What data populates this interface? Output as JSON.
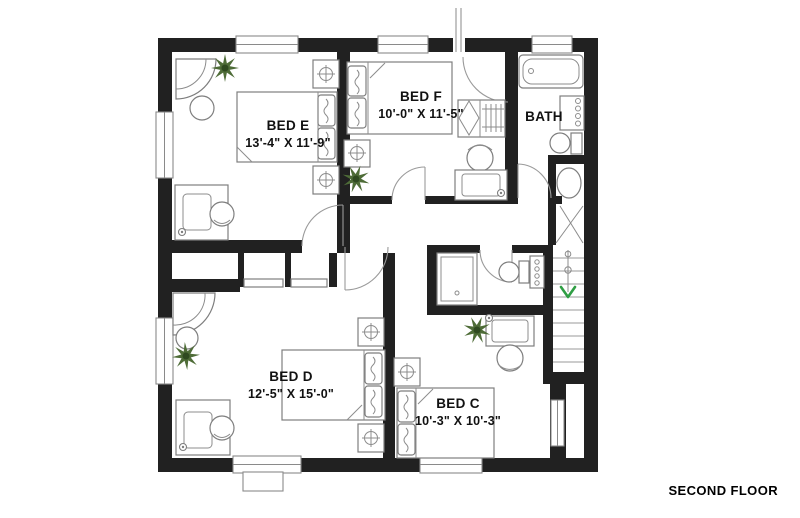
{
  "title": "SECOND FLOOR",
  "rooms": [
    {
      "id": "bed-e",
      "name": "BED E",
      "dims": "13'-4\" X 11'-9\""
    },
    {
      "id": "bed-f",
      "name": "BED F",
      "dims": "10'-0\" X 11'-5\""
    },
    {
      "id": "bath",
      "name": "BATH",
      "dims": ""
    },
    {
      "id": "bed-d",
      "name": "BED D",
      "dims": "12'-5\" X 15'-0\""
    },
    {
      "id": "bed-c",
      "name": "BED C",
      "dims": "10'-3\" X 10'-3\""
    }
  ],
  "stairs": {
    "icon": "stairs-down-arrow",
    "arrow_color": "#2f9e44"
  },
  "icons": {
    "plant": "plant-burst",
    "bed": "double-bed",
    "lamp": "nightstand-lamp-cross-circle",
    "bathtub": "bathtub",
    "toilet": "toilet",
    "shower": "shower-stall",
    "desk": "desk-with-chair",
    "closet": "bifold-closet-with-hangers"
  },
  "colors": {
    "wall": "#212121",
    "furniture_line": "#7e7e7e",
    "plant_green": "#4e6c37",
    "stairs_arrow": "#2f9e44",
    "background": "#ffffff",
    "text": "#111111"
  }
}
